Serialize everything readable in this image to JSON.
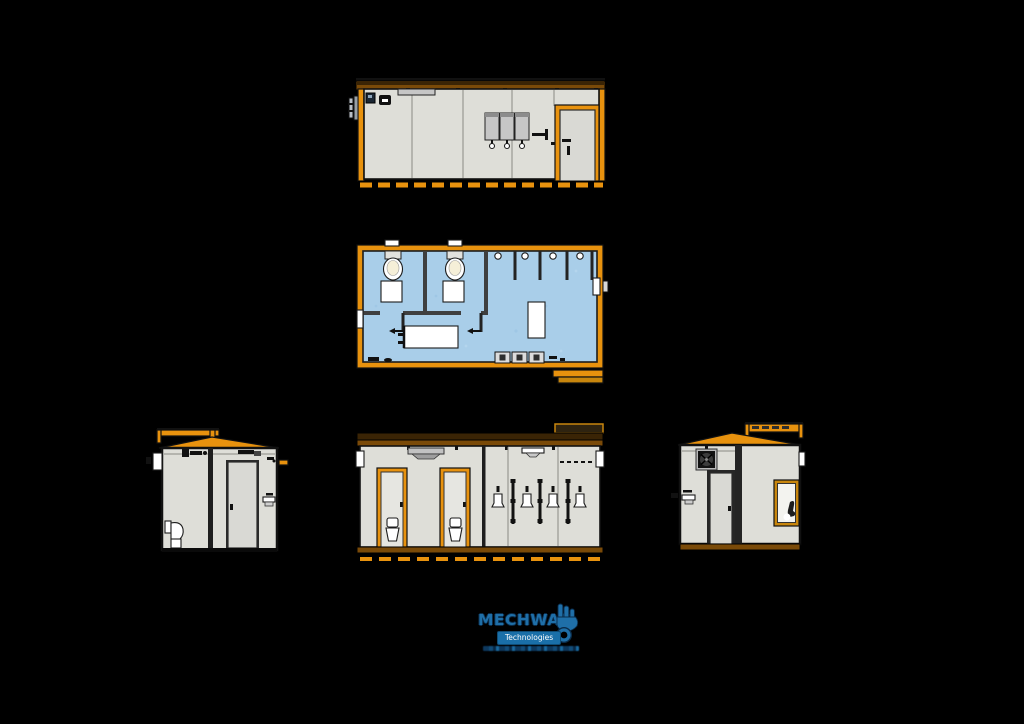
{
  "logo": {
    "brand": "MECHWAT",
    "subtitle": "Technologies"
  },
  "colors": {
    "background": "#000000",
    "orange": "#E8920E",
    "orange-deep": "#C8860D",
    "roof-dark": "#3A2405",
    "roof-mid": "#7A4A08",
    "wall": "#DEDED8",
    "door": "#D9D9D4",
    "line": "#111111",
    "plan-wall": "#3F3F3F",
    "floor": "#A9CEE9",
    "fixture": "#FFFFFF",
    "bowl": "#F5EFD8",
    "unit": "#C6C6C6",
    "logo-blue": "#1F6FA8",
    "logo-navy": "#0A2C4A",
    "logo-box": "#1A6FA8"
  }
}
